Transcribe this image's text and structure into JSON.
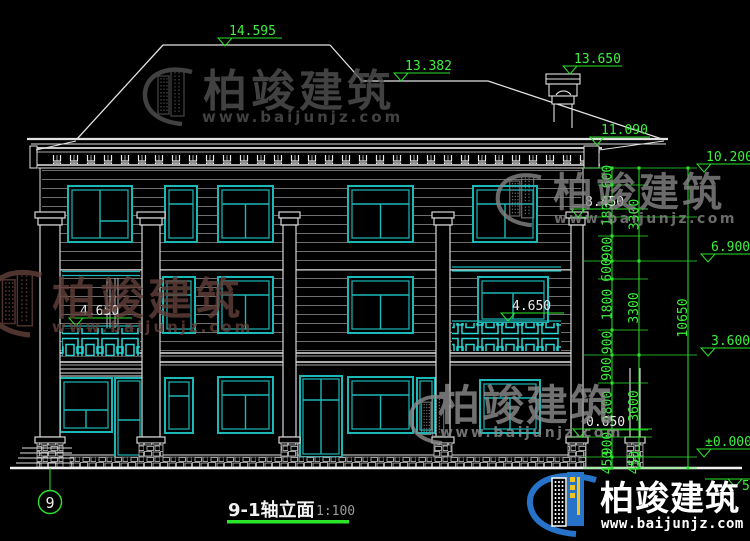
{
  "drawing": {
    "title": "9-1轴立面",
    "scale": "1:100",
    "axis_label": "9"
  },
  "levels": {
    "ridge_main": "14.595",
    "ridge_right": "13.382",
    "chimney": "13.650",
    "eave": "11.090",
    "top": "10.200",
    "column_capital": "8.450",
    "floor3": "6.900",
    "balcony_left": "4.650",
    "balcony_right": "4.650",
    "floor2": "3.600",
    "porch": "0.650",
    "zero": "±0.000",
    "edge_fragment": "50"
  },
  "dims": {
    "inner": [
      "600",
      "1800",
      "900",
      "600",
      "1800",
      "900",
      "900",
      "1800",
      "900",
      "450"
    ],
    "mid": [
      "3300",
      "3300",
      "3600",
      "450"
    ],
    "total": "10650"
  },
  "watermark": {
    "brand": "柏竣建筑",
    "url": "www.baijunjz.com"
  },
  "footer_logo": {
    "brand": "柏竣建筑",
    "url": "www.baijunjz.com"
  },
  "colors": {
    "cad_green": "#2ae52a",
    "cad_cyan": "#1cb8b8",
    "logo_blue": "#2673c9",
    "logo_yellow": "#f2c21d"
  }
}
